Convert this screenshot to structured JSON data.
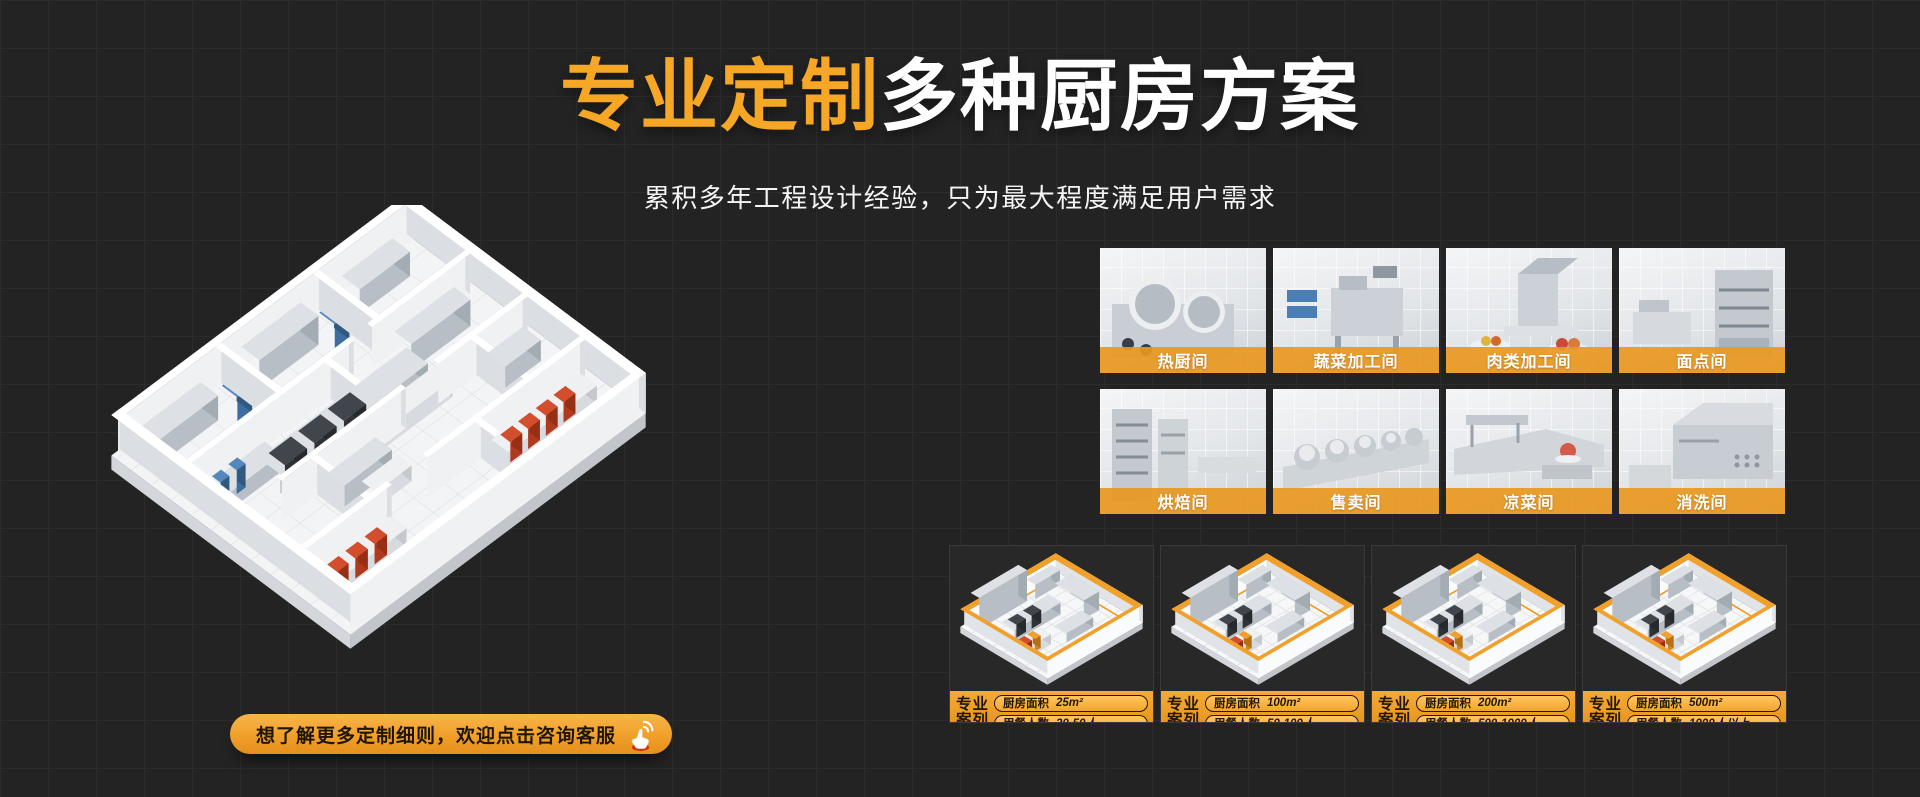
{
  "hero": {
    "title_highlight": "专业定制",
    "title_rest": "多种厨房方案",
    "subtitle": "累积多年工程设计经验，只为最大程度满足用户需求"
  },
  "cta": {
    "label": "想了解更多定制细则，欢迎点击咨询客服",
    "icon": "hand-click-icon"
  },
  "room_tiles": [
    {
      "label": "热厨间"
    },
    {
      "label": "蔬菜加工间"
    },
    {
      "label": "肉类加工间"
    },
    {
      "label": "面点间"
    },
    {
      "label": "烘焙间"
    },
    {
      "label": "售卖间"
    },
    {
      "label": "凉菜间"
    },
    {
      "label": "消洗间"
    }
  ],
  "case_cards": [
    {
      "badge_line1": "专业",
      "badge_line2": "案列",
      "area_label": "厨房面积",
      "area_value": "25m²",
      "diners_label": "用餐人数",
      "diners_value": "20-50人"
    },
    {
      "badge_line1": "专业",
      "badge_line2": "案列",
      "area_label": "厨房面积",
      "area_value": "100m²",
      "diners_label": "用餐人数",
      "diners_value": "50-100人"
    },
    {
      "badge_line1": "专业",
      "badge_line2": "案列",
      "area_label": "厨房面积",
      "area_value": "200m²",
      "diners_label": "用餐人数",
      "diners_value": "500-1000人"
    },
    {
      "badge_line1": "专业",
      "badge_line2": "案列",
      "area_label": "厨房面积",
      "area_value": "500m²",
      "diners_label": "用餐人数",
      "diners_value": "1000人以上"
    }
  ],
  "colors": {
    "accent": "#F7A726",
    "accent_deep": "#E08F16",
    "background": "#232323",
    "text_light": "#FFFFFF",
    "text_dark": "#221703"
  }
}
